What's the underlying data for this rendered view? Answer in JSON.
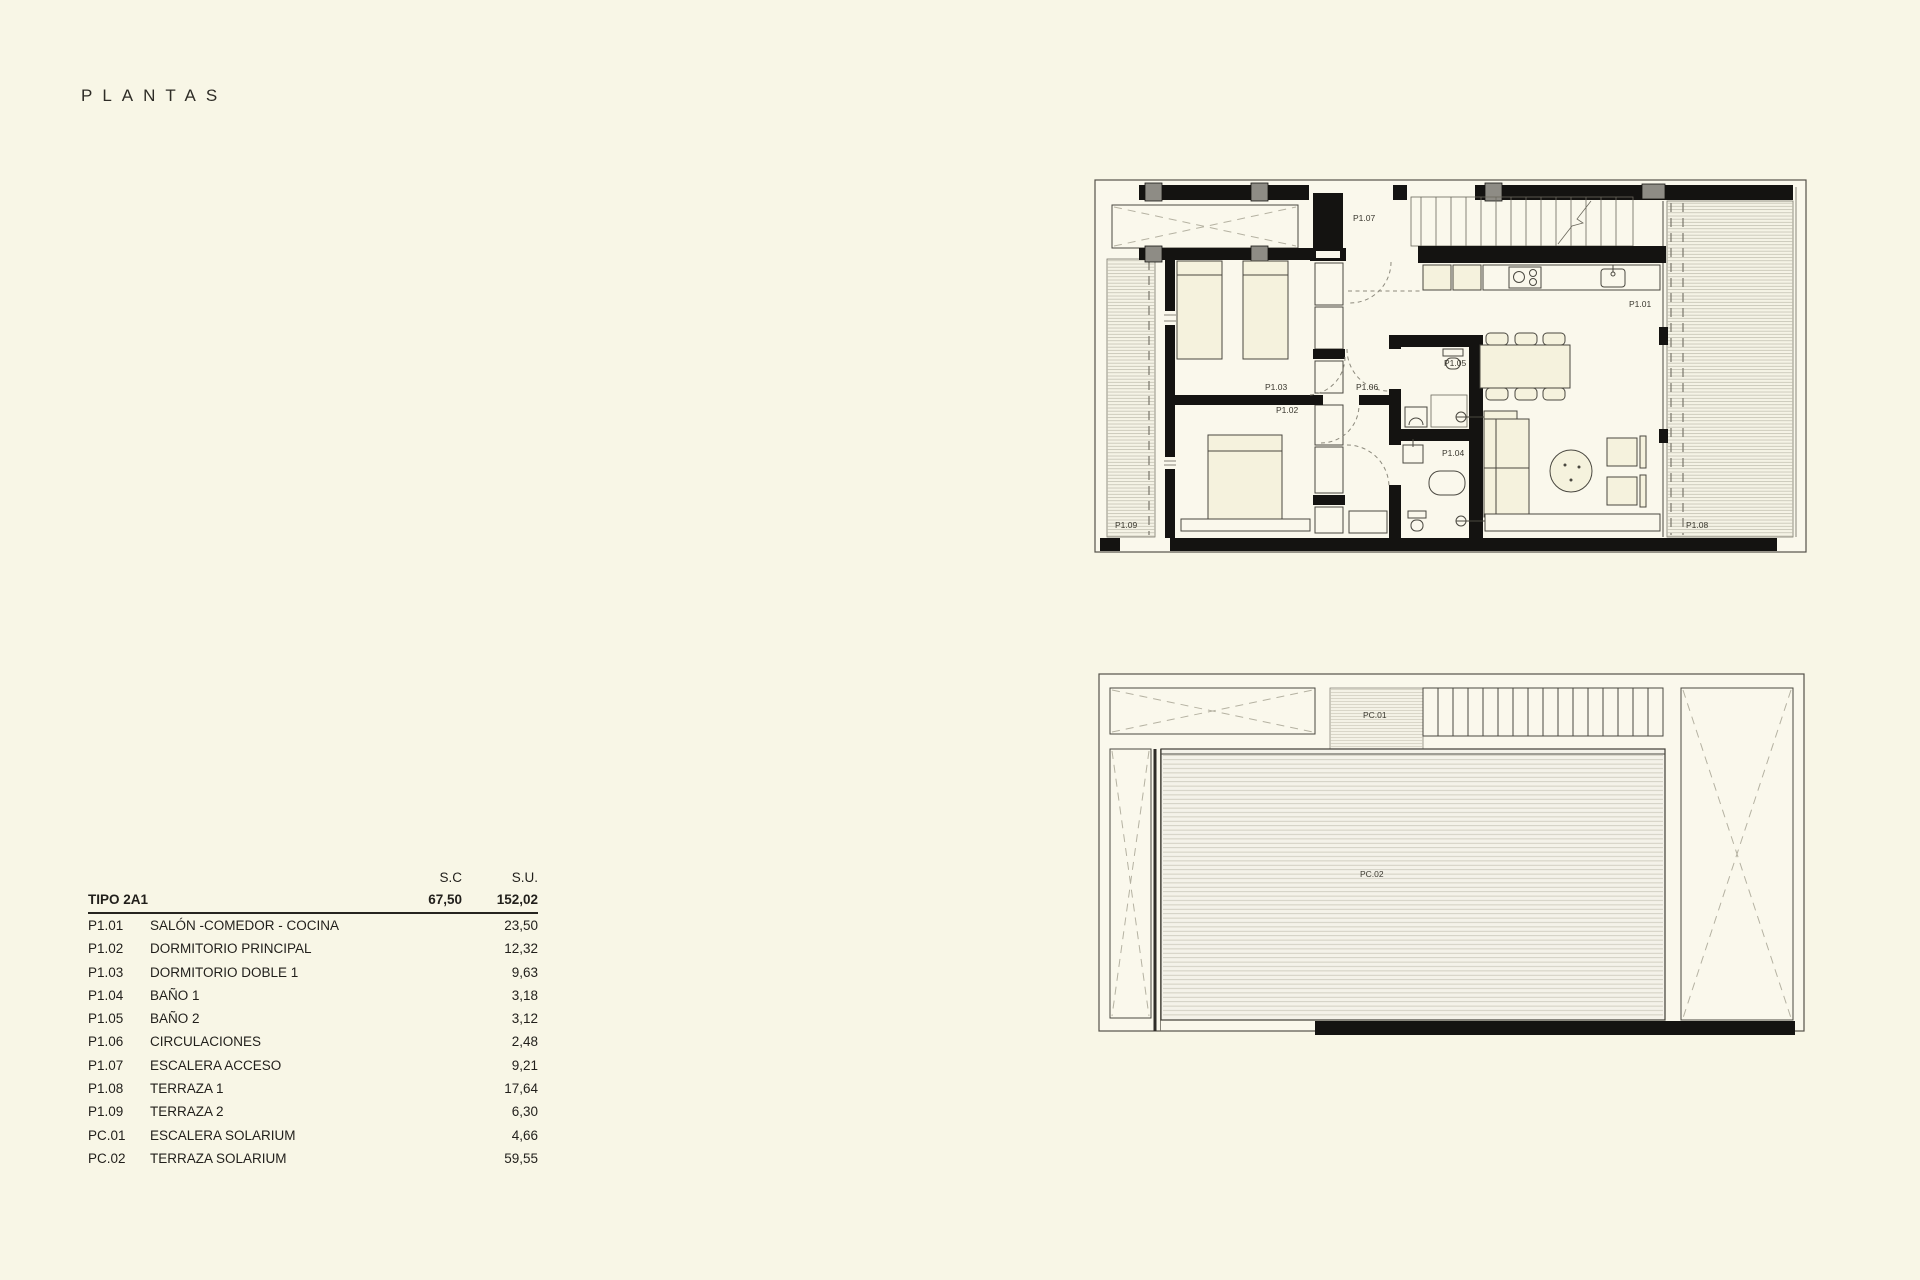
{
  "page": {
    "title": "PLANTAS",
    "background": "#f8f6e6"
  },
  "areas_table": {
    "header": {
      "sc": "S.C",
      "su": "S.U."
    },
    "type_row": {
      "label": "TIPO 2A1",
      "sc": "67,50",
      "su": "152,02"
    },
    "rows": [
      {
        "code": "P1.01",
        "name": "SALÓN -COMEDOR - COCINA",
        "su": "23,50"
      },
      {
        "code": "P1.02",
        "name": "DORMITORIO PRINCIPAL",
        "su": "12,32"
      },
      {
        "code": "P1.03",
        "name": "DORMITORIO DOBLE 1",
        "su": "9,63"
      },
      {
        "code": "P1.04",
        "name": "BAÑO 1",
        "su": "3,18"
      },
      {
        "code": "P1.05",
        "name": "BAÑO 2",
        "su": "3,12"
      },
      {
        "code": "P1.06",
        "name": "CIRCULACIONES",
        "su": "2,48"
      },
      {
        "code": "P1.07",
        "name": "ESCALERA ACCESO",
        "su": "9,21"
      },
      {
        "code": "P1.08",
        "name": "TERRAZA 1",
        "su": "17,64"
      },
      {
        "code": "P1.09",
        "name": "TERRAZA 2",
        "su": "6,30"
      },
      {
        "code": "PC.01",
        "name": "ESCALERA SOLARIUM",
        "su": "4,66"
      },
      {
        "code": "PC.02",
        "name": "TERRAZA SOLARIUM",
        "su": "59,55"
      }
    ]
  },
  "floor_plan": {
    "labels": {
      "p1_01": "P1.01",
      "p1_02": "P1.02",
      "p1_03": "P1.03",
      "p1_04": "P1.04",
      "p1_05": "P1.05",
      "p1_06": "P1.06",
      "p1_07": "P1.07",
      "p1_08": "P1.08",
      "p1_09": "P1.09"
    }
  },
  "solarium_plan": {
    "labels": {
      "pc_01": "PC.01",
      "pc_02": "PC.02"
    }
  },
  "colors": {
    "paper": "#f8f6e6",
    "wall": "#141311",
    "line": "#4a4840",
    "hatch": "#bcb9aa",
    "furniture": "#f5f2dd"
  }
}
